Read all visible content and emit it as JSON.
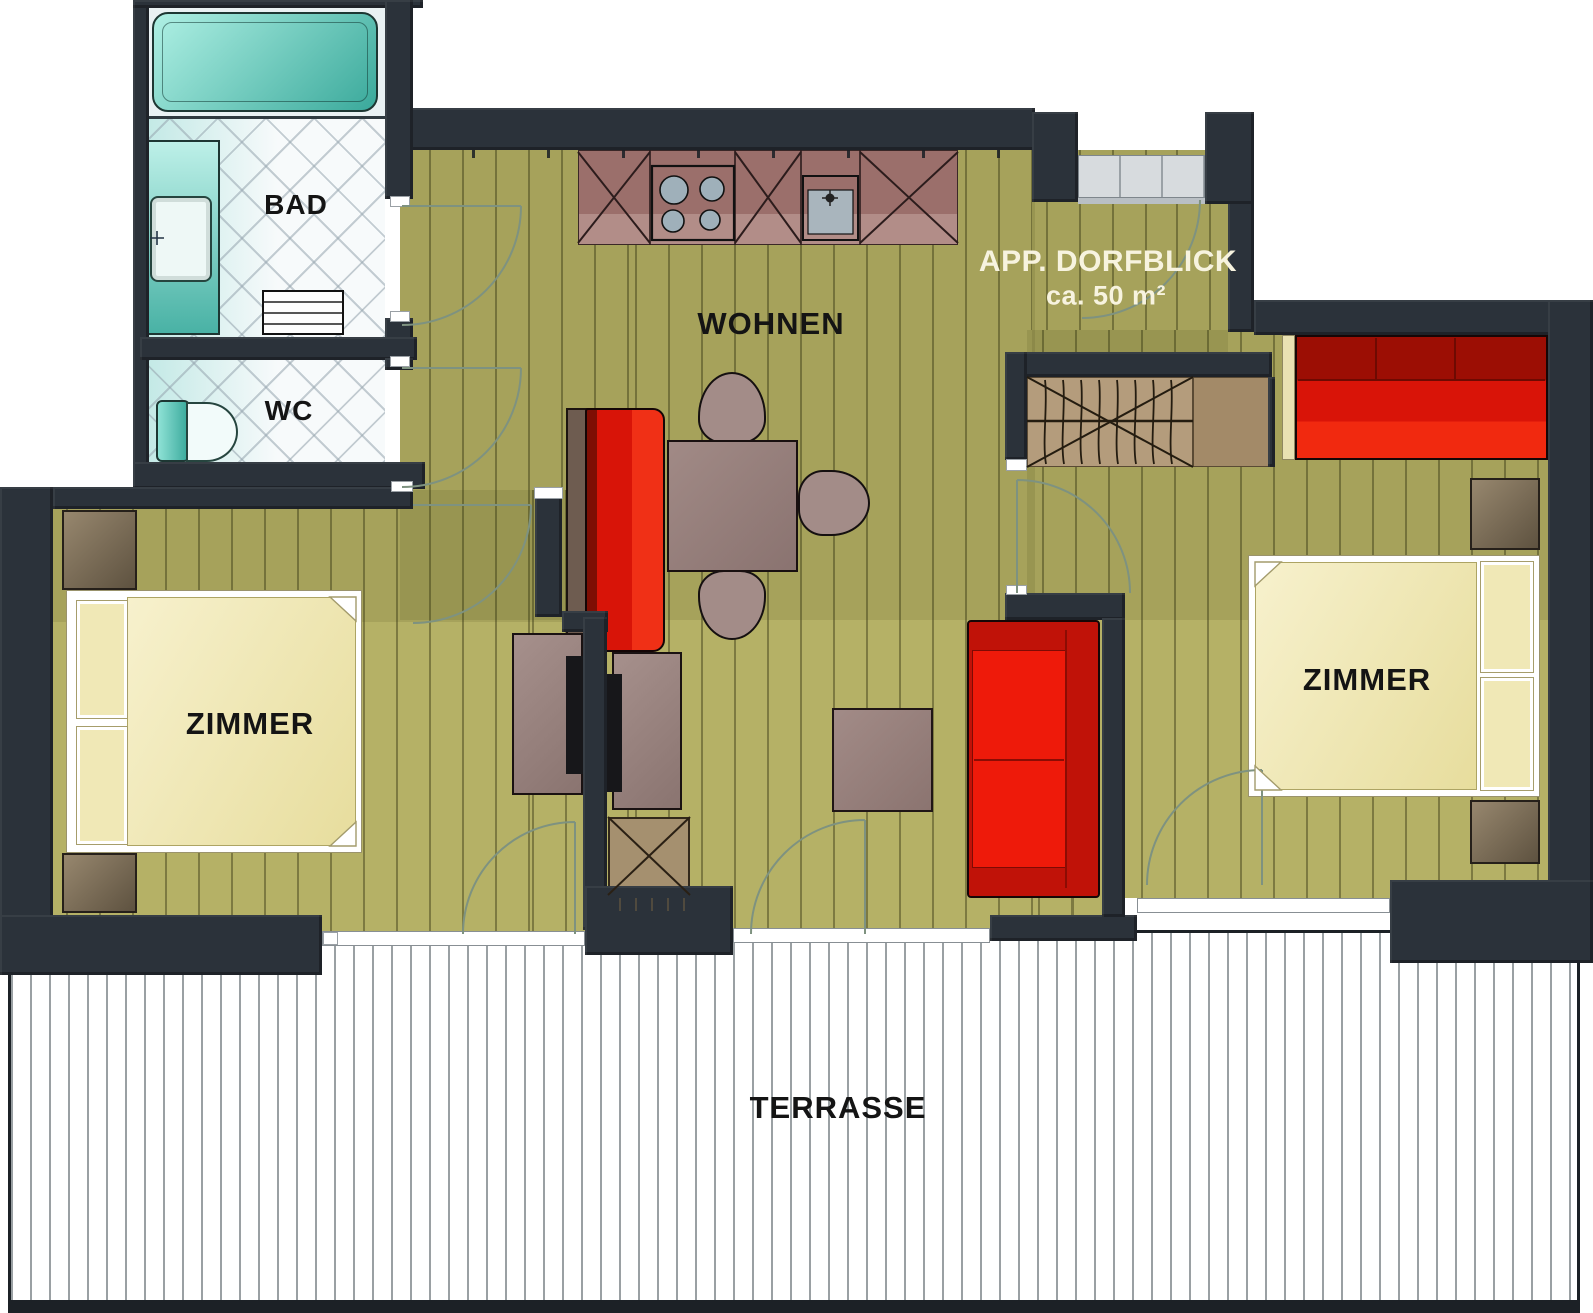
{
  "plan": {
    "title": "APP. DORFBLICK",
    "area_label": "ca. 50 m²",
    "rooms": {
      "bad": {
        "label": "BAD"
      },
      "wc": {
        "label": "WC"
      },
      "wohnen": {
        "label": "WOHNEN"
      },
      "zimmer_left": {
        "label": "ZIMMER"
      },
      "zimmer_right": {
        "label": "ZIMMER"
      },
      "terrasse": {
        "label": "TERRASSE"
      }
    },
    "colors": {
      "wall": "#2b323a",
      "wood_floor": "#b5b166",
      "terrace_floor": "#ffffff",
      "tile_floor": "#f7fafb",
      "red_furniture": "#e01408",
      "mauve_furniture": "#a18a86",
      "kitchen_counter": "#9b6f6b",
      "sanitary_teal": "#63cdbf",
      "bed_cream": "#f3edc4",
      "stairs_tan": "#b49c7c",
      "label_dark": "#141414",
      "label_light": "#f7f3df"
    }
  }
}
